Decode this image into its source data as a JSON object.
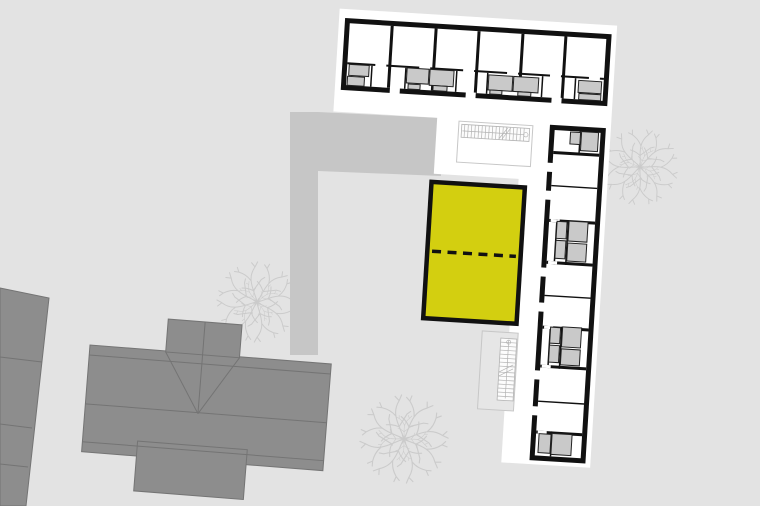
{
  "scene": {
    "kind": "architectural site plan",
    "highlighted_unit": "selected apartment unit"
  },
  "colors": {
    "background": "#e3e3e3",
    "road": "#c6c6c6",
    "parcel": "#ffffff",
    "wall": "#111111",
    "room": "#ffffff",
    "fixture": "#c9c9c9",
    "fixture_outline": "#222222",
    "highlight": "#d3cf10",
    "dash": "#111111",
    "roof": "#8d8d8d",
    "roof_line": "#747474",
    "tree": "#cbcbcb",
    "stair_line": "#b3b3b3",
    "stair_band": "#fcfcfc",
    "terrace_fill": "#e6e6e6",
    "terrace_outline": "#c7c7c7"
  }
}
